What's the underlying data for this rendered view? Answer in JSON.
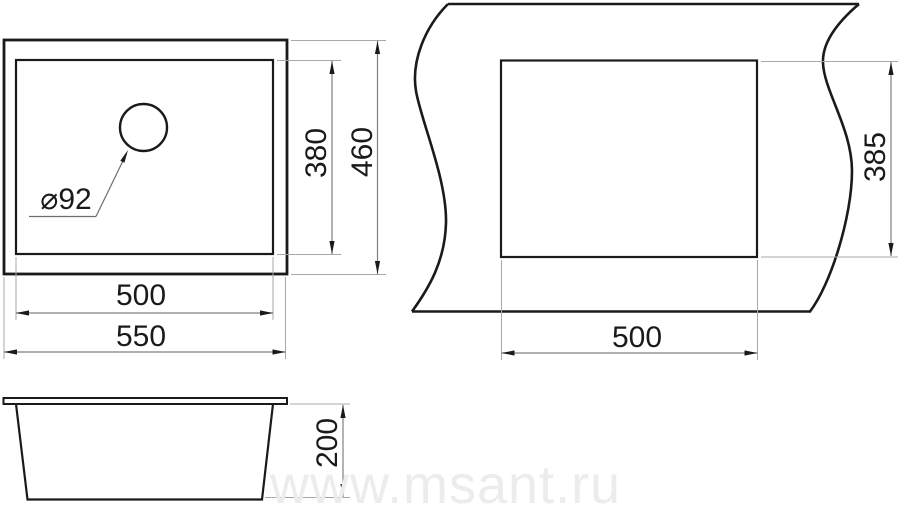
{
  "views": {
    "top": {
      "drain_diameter_label": "⌀92",
      "bowl_width_label": "500",
      "overall_width_label": "550",
      "bowl_depth_label": "380",
      "overall_depth_label": "460"
    },
    "cutout": {
      "width_label": "500",
      "height_label": "385"
    },
    "side": {
      "height_label": "200"
    }
  },
  "watermark": {
    "text": "www.msant.ru"
  },
  "colors": {
    "main_line": "#1a1a1a",
    "dim_line": "#808080",
    "extension_line": "#a8a8a8",
    "text": "#1a1a1a",
    "watermark": "#ececec",
    "background": "#ffffff"
  }
}
